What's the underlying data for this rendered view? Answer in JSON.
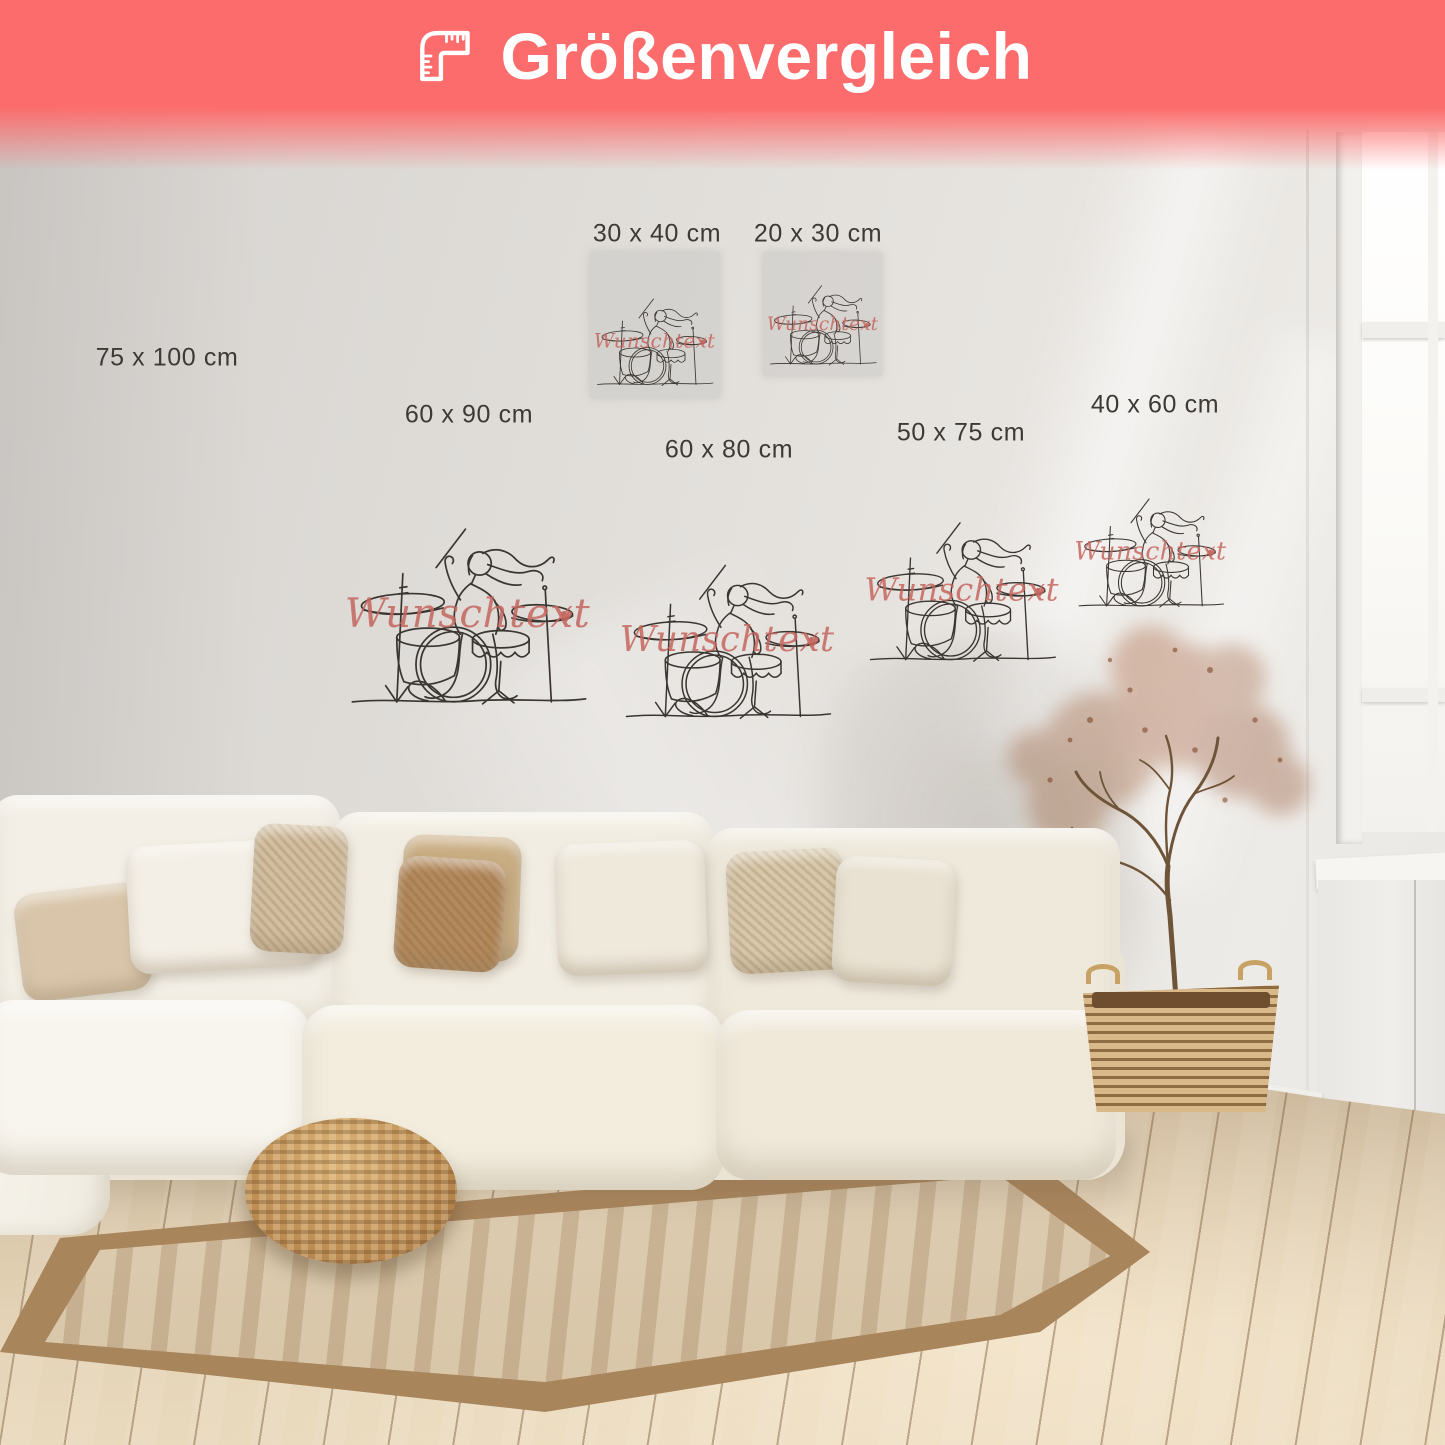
{
  "header": {
    "title": "Größenvergleich",
    "banner_color": "#FD6C6C",
    "icon": "corner-ruler"
  },
  "poster_text": {
    "value": "Wunschtext",
    "heart": "♥",
    "color": "#C4655E"
  },
  "labels": {
    "size_75x100": "75 x 100 cm",
    "size_30x40": "30 x 40 cm",
    "size_20x30": "20 x 30 cm",
    "size_60x90": "60 x 90 cm",
    "size_60x80": "60 x 80 cm",
    "size_50x75": "50 x 75 cm",
    "size_40x60": "40 x 60 cm"
  }
}
